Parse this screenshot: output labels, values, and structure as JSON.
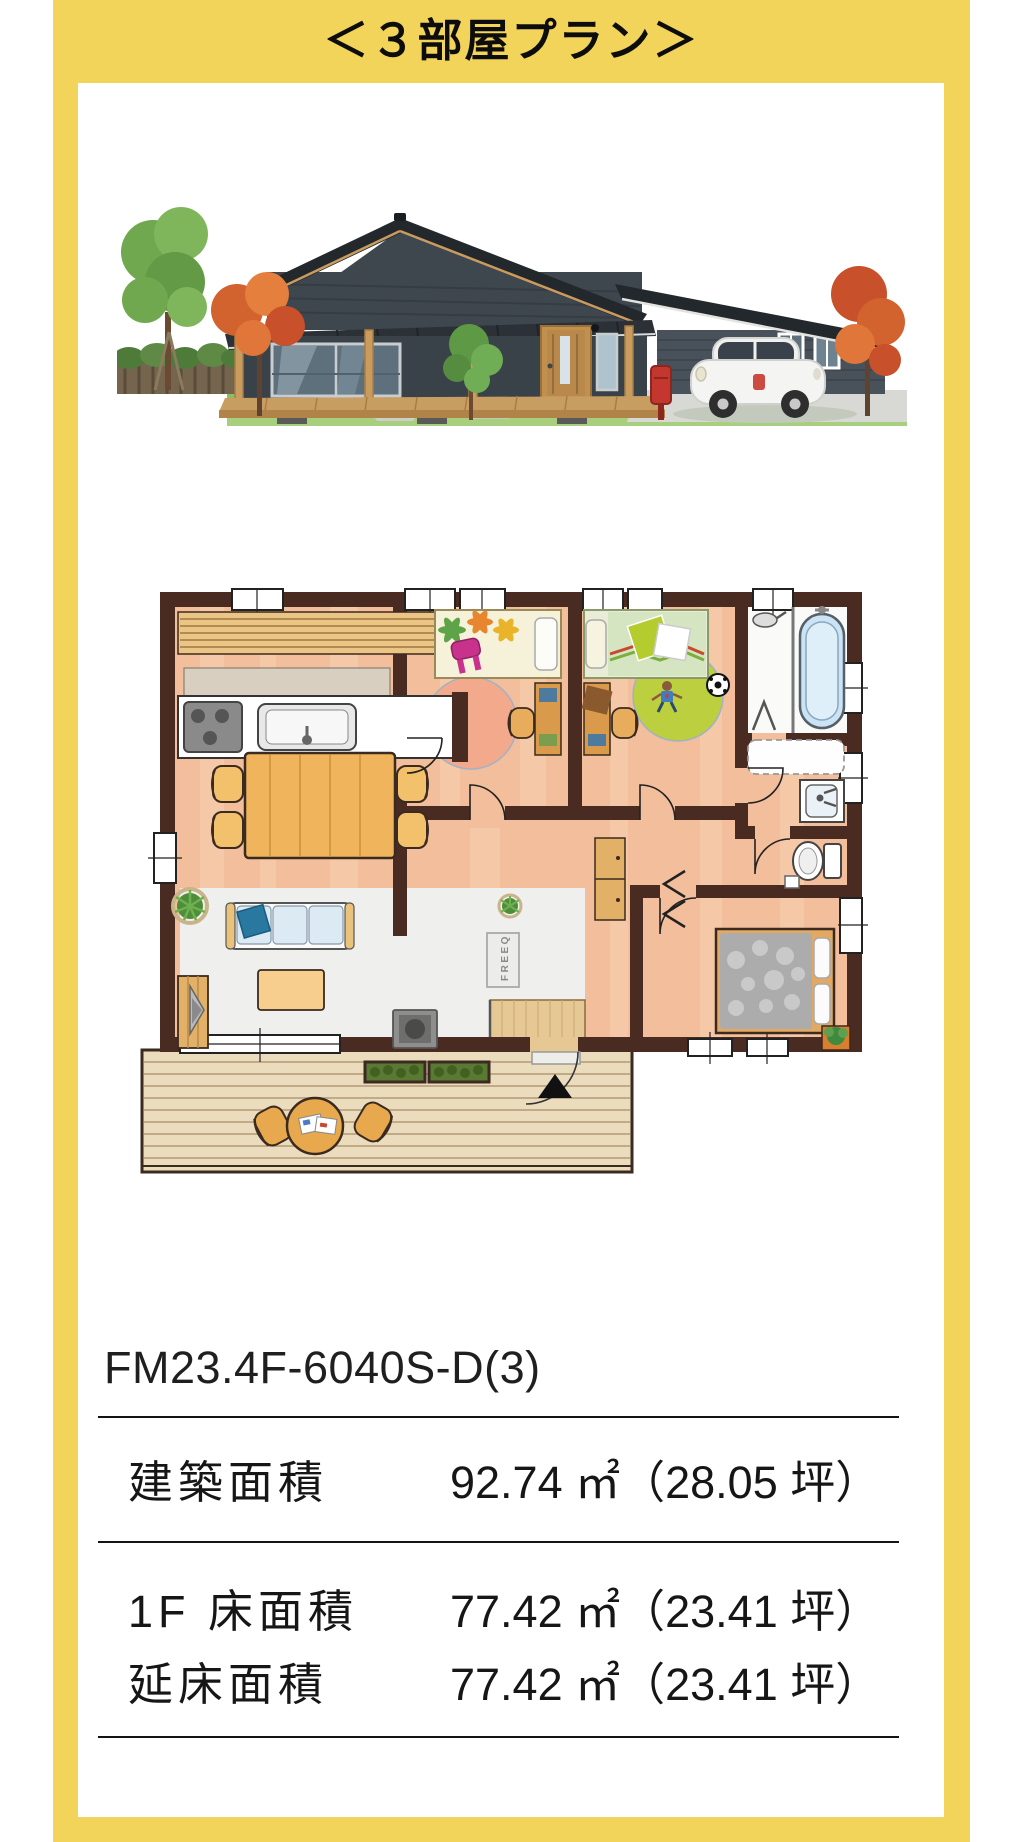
{
  "frame": {
    "title": "＜３部屋プラン＞",
    "color": "#F3D45A"
  },
  "model_code": "FM23.4F-6040S-D(3)",
  "spec_table": {
    "rows": [
      {
        "label": "建築面積",
        "value": "92.74 ㎡（28.05 坪）"
      },
      {
        "label": "1F 床面積",
        "value": "77.42 ㎡（23.41 坪）"
      },
      {
        "label": "延床面積",
        "value": "77.42 ㎡（23.41 坪）"
      }
    ]
  },
  "floor_plan": {
    "logo_label": "FREEQ",
    "palette": {
      "wall": "#4A2B22",
      "floor_wood": "#F2BE9B",
      "floor_living": "#EFEFED",
      "deck": "#EBDCBE",
      "rug_pink": "#F2A98C",
      "rug_green": "#BCCF3E",
      "furniture_wood": "#EFB45C",
      "bathtub": "#CBE3F4",
      "bed_gray": "#ACACAC"
    }
  },
  "house_rendering": {
    "palette": {
      "siding_dark": "#3F474E",
      "roof": "#23282D",
      "wood": "#C99B5F",
      "grass": "#8CBE62",
      "maple_orange": "#CE5B2C",
      "tree_green": "#6FA84F",
      "car_white": "#F4F5F3",
      "mailbox_red": "#C3372E"
    }
  }
}
